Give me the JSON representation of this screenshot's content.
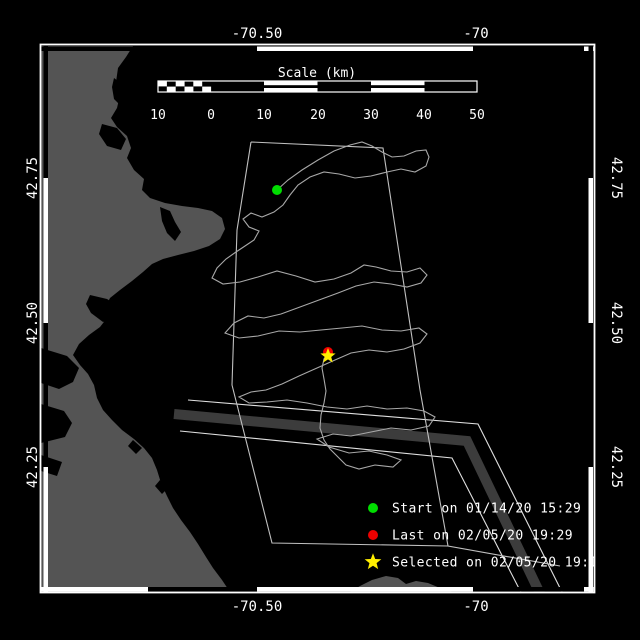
{
  "plot": {
    "type": "drifter-track-map",
    "region": "Massachusetts Bay / Stellwagen Bank"
  },
  "colors": {
    "background": "#000000",
    "sea": "#000000",
    "land": "#545454",
    "frame": "#ffffff",
    "track": "#a8a8a8",
    "boundary": "#c0c0c0",
    "tss_zone": "#3c3c3c",
    "tss_line": "#e0e0e0",
    "label_text": "#ffffff"
  },
  "axis_labels": {
    "top": [
      "-70.50",
      "-70"
    ],
    "bottom": [
      "-70.50",
      "-70"
    ],
    "left": [
      "42.75",
      "42.50",
      "42.25"
    ],
    "right": [
      "42.75",
      "42.50",
      "42.25"
    ]
  },
  "scale_bar": {
    "title": "Scale (km)",
    "labels": [
      "10",
      "0",
      "10",
      "20",
      "30",
      "40",
      "50"
    ]
  },
  "legend": {
    "items": [
      {
        "marker": "circle",
        "color": "#00dd00",
        "label": "Start on 01/14/20 15:29"
      },
      {
        "marker": "circle",
        "color": "#ee0000",
        "label": "Last on 02/05/20 19:29"
      },
      {
        "marker": "star",
        "color": "#ffee00",
        "label": "Selected on 02/05/20 19:14"
      }
    ]
  }
}
